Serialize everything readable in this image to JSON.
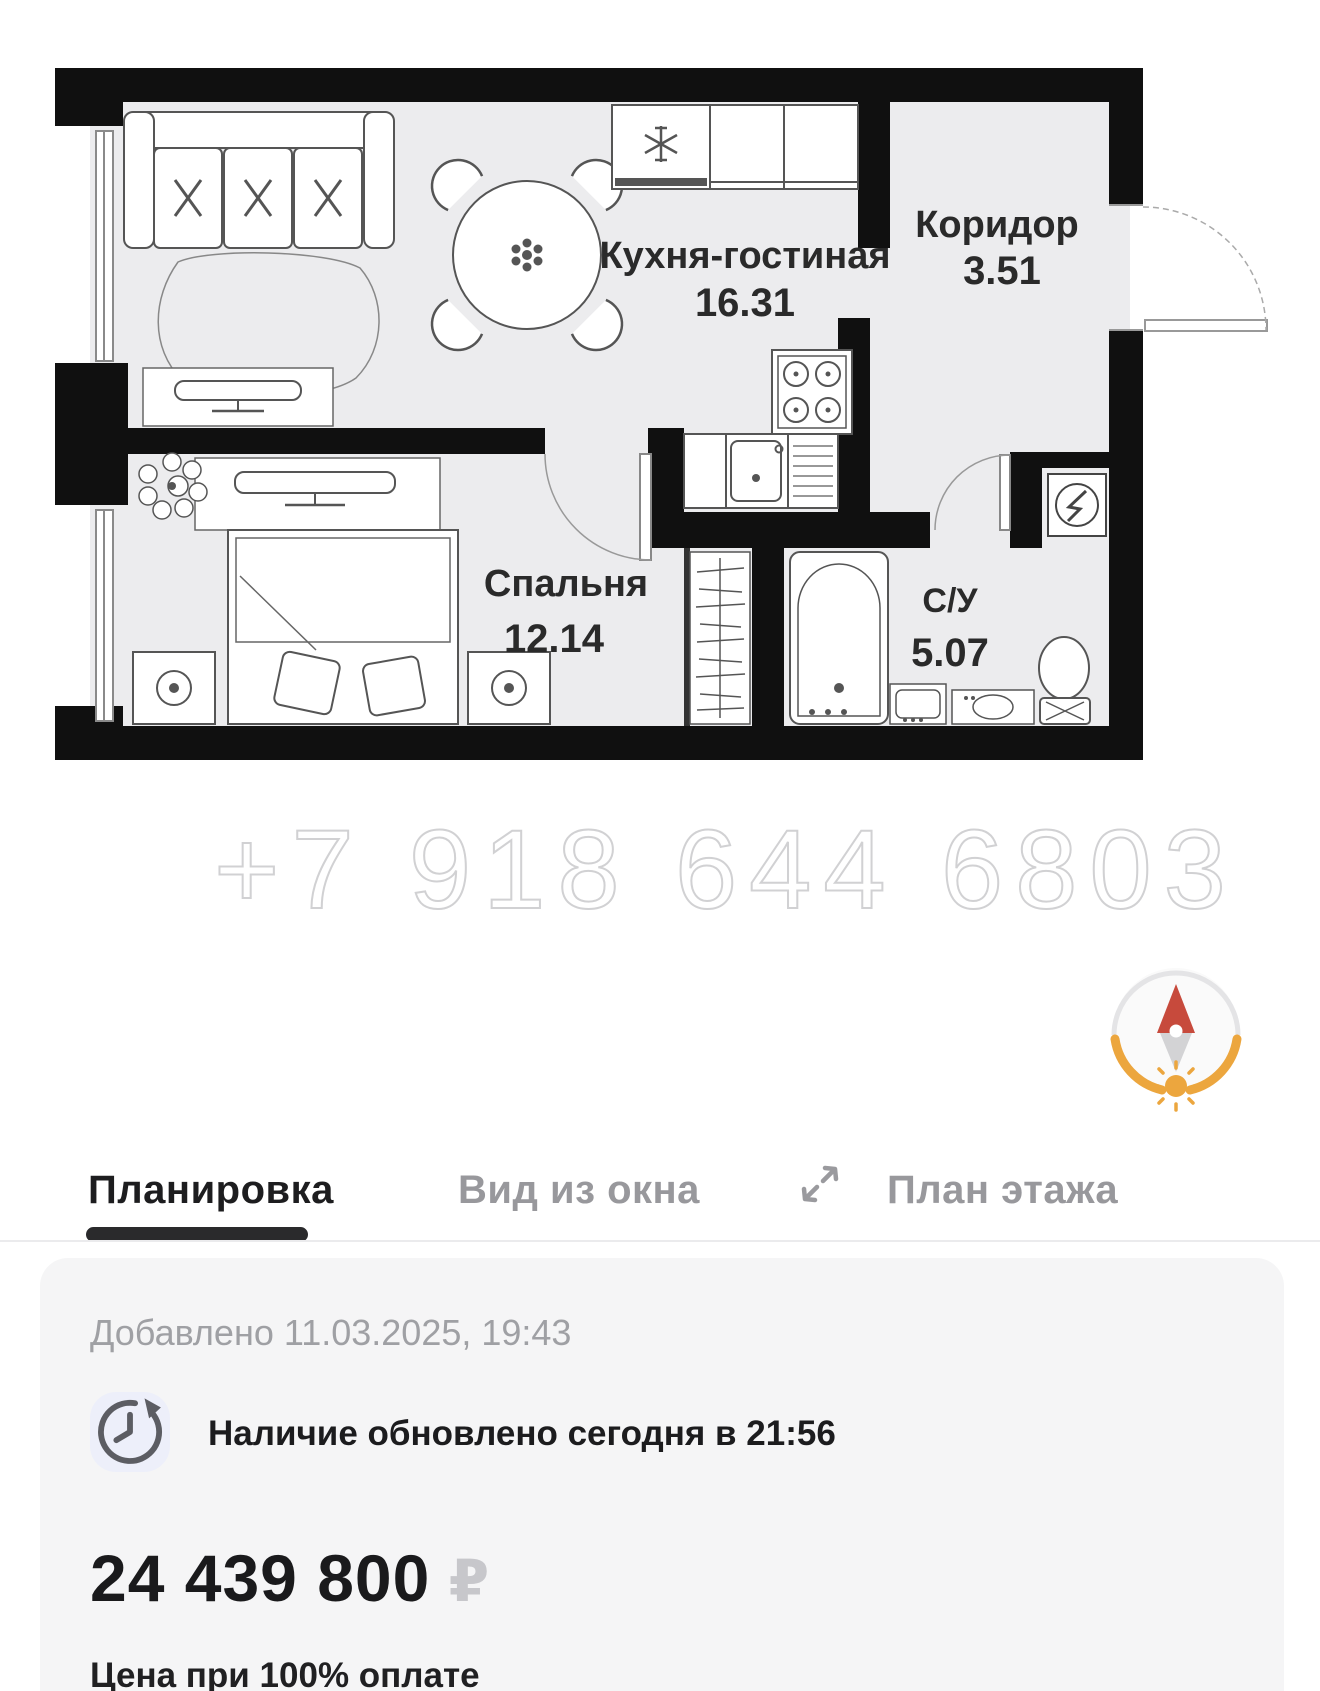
{
  "floor_plan": {
    "rooms": [
      {
        "id": "kitchen-living",
        "name": "Кухня-гостиная",
        "area": "16.31"
      },
      {
        "id": "corridor",
        "name": "Коридор",
        "area": "3.51"
      },
      {
        "id": "bedroom",
        "name": "Спальня",
        "area": "12.14"
      },
      {
        "id": "bathroom",
        "name": "С/У",
        "area": "5.07"
      }
    ],
    "watermark": "+7 918 644 6803"
  },
  "tabs": {
    "layout": "Планировка",
    "window_view": "Вид из окна",
    "floor_plan": "План этажа"
  },
  "card": {
    "added_date": "Добавлено 11.03.2025, 19:43",
    "availability": "Наличие обновлено сегодня в 21:56",
    "price": "24 439 800",
    "currency": "₽",
    "price_note": "Цена при 100% оплате"
  },
  "colors": {
    "wall": "#101010",
    "room_fill": "#ececee",
    "compass_north": "#c74a3c",
    "compass_sun": "#eca63e",
    "tab_active": "#1d1d1f",
    "tab_inactive": "#98989c",
    "card_bg": "#f5f5f6",
    "currency_gray": "#c7c7cb"
  }
}
